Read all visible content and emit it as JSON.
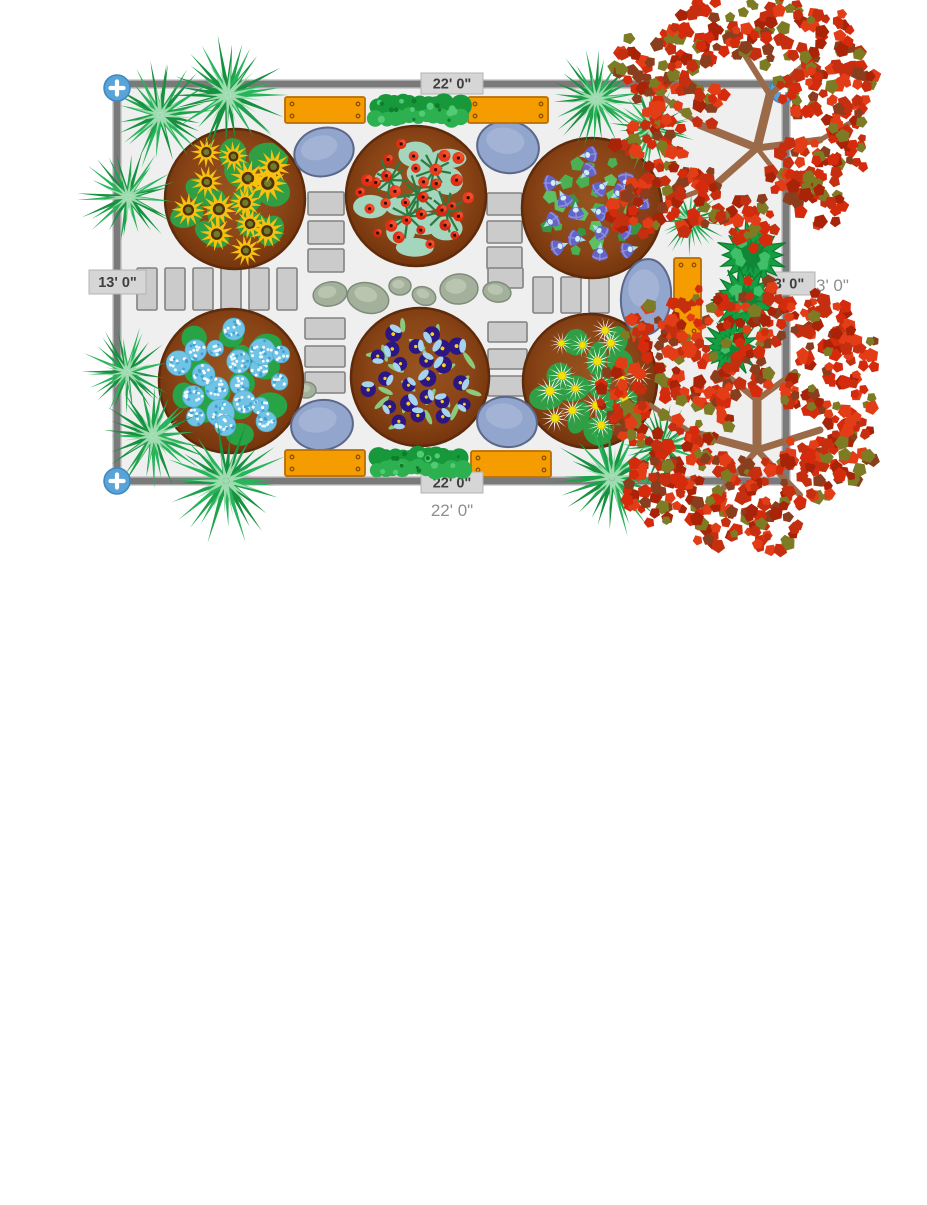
{
  "labels": {
    "top_width": "22' 0\"",
    "left_height": "13' 0\"",
    "right_tag": "3' 0\"",
    "bottom_width": "22' 0\"",
    "bottom_total": "22' 0\"",
    "right_total": "3' 0\""
  },
  "colors": {
    "plot_fill": "#efefef",
    "border": "#7a7a7a",
    "border_edge": "#a8a8a8",
    "paving_fill": "#cbcbcb",
    "paving_stroke": "#818181",
    "rock_fill": "#a3b09c",
    "rock_stroke": "#7e8c79",
    "rock_hi": "#bfcab4",
    "bstone_fill": "#92a5cd",
    "bstone_stroke": "#5c688a",
    "bstone_hi": "#aab9da",
    "bed_fill": "#8a4517",
    "bed_edge": "#6f3009",
    "bed_hi": "#96541f",
    "bed_stroke": "#5e2b0b",
    "bench_fill": "#f59d00",
    "bench_stroke": "#b96d00",
    "screw": "#8a5200",
    "hedge": {
      "back": "#17983a",
      "main": "#2db04f",
      "light": "#52cc74",
      "dot": "#0e7e2d"
    },
    "palm_outer": [
      "#1fa24c",
      "#28b45a",
      "#17913f"
    ],
    "palm_inner": "#9edcb0",
    "bush_fill": "#149e42",
    "bush_stroke": "#0c7c2f",
    "bush_dark": "#0e8234",
    "bush_hi": "#3fc068",
    "trunk": "#9b6a49",
    "tree_leaf": [
      "#d62a0d",
      "#c52f10",
      "#e23d16",
      "#a82307",
      "#7e7b25",
      "#8a3e1d"
    ],
    "handle_fill": "#58a3d8",
    "handle_stroke": "#3f87bf",
    "flowers": {
      "sunflower": {
        "petal": "#f6c110",
        "disk": "#543109",
        "eye": "#6f7d2b",
        "foliage": "#2f9e44"
      },
      "poppy": {
        "petal": [
          "#e03014",
          "#ea3c1c",
          "#d62a10"
        ],
        "hi": "#f25535",
        "dot": "#330b06",
        "stem": "#2c7a40",
        "foliage": "#a3d6bd"
      },
      "mglory": {
        "bell": "#6463c8",
        "stripe": "#8f8edd",
        "throat": "#cfeef6",
        "tube": "#a9dcec",
        "leaf": [
          "#4cb052",
          "#379644",
          "#5fbf63"
        ]
      },
      "hydrangea": {
        "base": "#6fc3e5",
        "edge": "#58aed4",
        "dot_light": "#ffffff",
        "dot_dark": "#3f9fd0",
        "foliage": "#28a345"
      },
      "pansy": {
        "body": "#2c1683",
        "crest": "#a6d3ee",
        "eye": "#f0d322",
        "leaf": "#8cc97c"
      },
      "daisy": {
        "petal": "#ffffff",
        "center": "#f0e10a",
        "center_edge": "#d4b800",
        "foliage": "#2f9e44"
      }
    }
  },
  "scene": {
    "plot": {
      "x": 117,
      "y": 84,
      "w": 669,
      "h": 397
    },
    "handles": [
      [
        117,
        88
      ],
      [
        783,
        90
      ],
      [
        117,
        481
      ]
    ],
    "paving": [
      [
        137,
        268,
        20,
        42
      ],
      [
        165,
        268,
        20,
        42
      ],
      [
        193,
        268,
        20,
        42
      ],
      [
        221,
        268,
        20,
        42
      ],
      [
        249,
        268,
        20,
        42
      ],
      [
        277,
        268,
        20,
        42
      ],
      [
        533,
        277,
        20,
        36
      ],
      [
        561,
        277,
        20,
        36
      ],
      [
        589,
        277,
        20,
        36
      ],
      [
        308,
        192,
        36,
        23
      ],
      [
        308,
        221,
        36,
        23
      ],
      [
        308,
        249,
        36,
        23
      ],
      [
        305,
        318,
        40,
        21
      ],
      [
        305,
        346,
        40,
        21
      ],
      [
        305,
        372,
        40,
        21
      ],
      [
        487,
        193,
        35,
        22
      ],
      [
        487,
        221,
        35,
        22
      ],
      [
        487,
        247,
        35,
        22
      ],
      [
        488,
        268,
        35,
        20
      ],
      [
        488,
        322,
        39,
        20
      ],
      [
        488,
        349,
        39,
        20
      ],
      [
        488,
        376,
        39,
        20
      ]
    ],
    "rocks": [
      [
        330,
        294,
        17,
        12,
        -10
      ],
      [
        368,
        298,
        21,
        15,
        15
      ],
      [
        400,
        286,
        11,
        9,
        0
      ],
      [
        424,
        296,
        12,
        9,
        20
      ],
      [
        459,
        289,
        19,
        15,
        -5
      ],
      [
        497,
        292,
        14,
        10,
        10
      ],
      [
        306,
        390,
        10,
        8,
        0
      ]
    ],
    "blue_stones": [
      [
        324,
        152,
        30,
        24,
        -15
      ],
      [
        508,
        147,
        31,
        26,
        10
      ],
      [
        646,
        297,
        25,
        38,
        5
      ],
      [
        322,
        425,
        31,
        25,
        -8
      ],
      [
        507,
        422,
        30,
        25,
        8
      ]
    ],
    "beds": [
      {
        "type": "sunflowers",
        "cx": 235,
        "cy": 199,
        "r": 70
      },
      {
        "type": "poppies",
        "cx": 416,
        "cy": 196,
        "r": 70
      },
      {
        "type": "morning-glory",
        "cx": 592,
        "cy": 208,
        "r": 70
      },
      {
        "type": "hydrangeas",
        "cx": 231,
        "cy": 381,
        "r": 72
      },
      {
        "type": "pansies",
        "cx": 420,
        "cy": 377,
        "r": 69
      },
      {
        "type": "daisies",
        "cx": 590,
        "cy": 381,
        "r": 67
      }
    ],
    "benches": [
      [
        285,
        97,
        80,
        26
      ],
      [
        468,
        97,
        80,
        26
      ],
      [
        285,
        450,
        80,
        26
      ],
      [
        471,
        451,
        80,
        26
      ],
      [
        674,
        258,
        27,
        80
      ]
    ],
    "hedges": [
      [
        371,
        96,
        95,
        30
      ],
      [
        371,
        448,
        96,
        30
      ]
    ],
    "palms": [
      [
        160,
        115,
        56
      ],
      [
        228,
        95,
        60
      ],
      [
        128,
        197,
        50
      ],
      [
        596,
        99,
        52
      ],
      [
        652,
        128,
        46
      ],
      [
        690,
        220,
        36
      ],
      [
        127,
        372,
        46
      ],
      [
        153,
        436,
        56
      ],
      [
        226,
        481,
        62
      ],
      [
        612,
        478,
        58
      ],
      [
        663,
        446,
        44
      ]
    ],
    "bushes": [
      [
        752,
        255,
        34
      ],
      [
        745,
        300,
        32
      ],
      [
        731,
        347,
        28
      ]
    ],
    "trees": [
      {
        "branches": [
          [
            757,
            148,
            770,
            95,
            9
          ],
          [
            770,
            95,
            745,
            55,
            6
          ],
          [
            770,
            95,
            810,
            60,
            6
          ],
          [
            757,
            148,
            700,
            125,
            8
          ],
          [
            700,
            125,
            660,
            95,
            5
          ],
          [
            757,
            148,
            820,
            140,
            7
          ],
          [
            820,
            140,
            855,
            120,
            5
          ],
          [
            757,
            148,
            715,
            185,
            7
          ],
          [
            715,
            185,
            675,
            200,
            5
          ],
          [
            757,
            148,
            790,
            190,
            5
          ]
        ],
        "clusters": [
          [
            648,
            60,
            34
          ],
          [
            706,
            36,
            38
          ],
          [
            770,
            28,
            38
          ],
          [
            828,
            46,
            36
          ],
          [
            852,
            92,
            28
          ],
          [
            842,
            142,
            34
          ],
          [
            800,
            170,
            32
          ],
          [
            802,
            92,
            26
          ],
          [
            686,
            98,
            38
          ],
          [
            641,
            126,
            32
          ],
          [
            660,
            170,
            34
          ],
          [
            700,
            202,
            34
          ],
          [
            638,
            214,
            28
          ],
          [
            748,
            222,
            28
          ],
          [
            815,
            200,
            30
          ]
        ]
      },
      {
        "branches": [
          [
            757,
            450,
            757,
            400,
            9
          ],
          [
            757,
            400,
            720,
            370,
            6
          ],
          [
            757,
            400,
            795,
            372,
            6
          ],
          [
            757,
            450,
            690,
            432,
            8
          ],
          [
            690,
            432,
            650,
            405,
            5
          ],
          [
            757,
            450,
            820,
            430,
            7
          ],
          [
            757,
            450,
            720,
            492,
            6
          ],
          [
            757,
            450,
            800,
            495,
            6
          ]
        ],
        "clusters": [
          [
            652,
            332,
            30
          ],
          [
            700,
            322,
            34
          ],
          [
            760,
            312,
            34
          ],
          [
            818,
            322,
            32
          ],
          [
            852,
            352,
            28
          ],
          [
            688,
            372,
            36
          ],
          [
            628,
            392,
            30
          ],
          [
            745,
            370,
            28
          ],
          [
            810,
            382,
            32
          ],
          [
            852,
            410,
            30
          ],
          [
            648,
            432,
            34
          ],
          [
            700,
            412,
            32
          ],
          [
            842,
            452,
            34
          ],
          [
            806,
            472,
            36
          ],
          [
            755,
            492,
            38
          ],
          [
            700,
            478,
            36
          ],
          [
            652,
            492,
            32
          ],
          [
            712,
            522,
            26
          ],
          [
            772,
            526,
            26
          ]
        ]
      }
    ]
  }
}
